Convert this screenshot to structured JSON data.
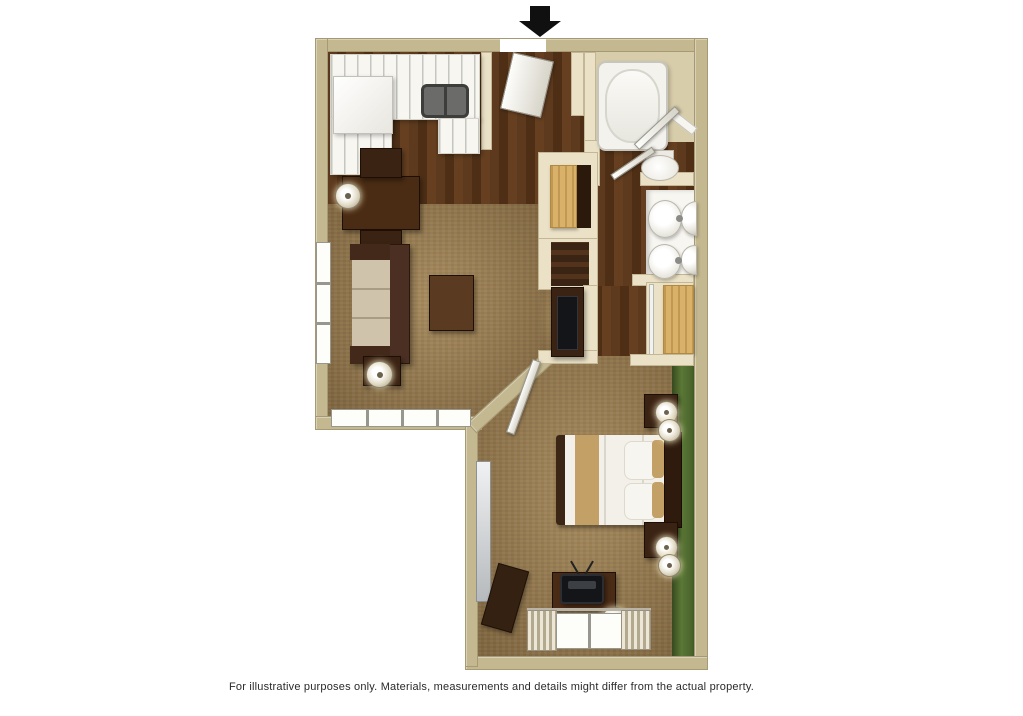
{
  "caption": "For illustrative purposes only.  Materials, measurements and details might differ from the actual property.",
  "entry_marker": "down-arrow",
  "palette": {
    "background": "#ffffff",
    "wall_tan": "#c4b891",
    "wall_edge": "#a59a74",
    "wall_cream": "#eae1c6",
    "wood_a": "#5d3a1e",
    "wood_b": "#4e2f16",
    "wood_c": "#653f20",
    "carpet": "#97794c",
    "green_a": "#5b7836",
    "fixture_white": "#f4f2ea",
    "counter_white": "#f7f6f1",
    "furn_dark": "#3b2313",
    "closet_wood": "#d9b168",
    "bed_gold": "#c3a065",
    "tv_black": "#141518",
    "arrow_color": "#101010",
    "caption_color": "#2a2a2a"
  },
  "scene": {
    "type": "3d-floor-plan-top-view",
    "rooms": [
      {
        "name": "kitchen",
        "furniture": [
          "l-shaped-counter",
          "refrigerator",
          "sink",
          "dining-table",
          "two-chairs",
          "wall-lamp"
        ]
      },
      {
        "name": "entry",
        "furniture": [
          "open-entry-door"
        ]
      },
      {
        "name": "living-room",
        "furniture": [
          "sofa",
          "end-table-with-lamp",
          "coffee-table",
          "tv-console",
          "side-window",
          "bottom-windows"
        ]
      },
      {
        "name": "bathroom",
        "furniture": [
          "bathtub",
          "toilet",
          "open-door",
          "towel-bar"
        ]
      },
      {
        "name": "vanity-area",
        "furniture": [
          "double-sinks",
          "mirror-reflections",
          "open-door"
        ]
      },
      {
        "name": "closets",
        "furniture": [
          "louvered-closet-door",
          "sliding-wood-closet-door",
          "linen-shelf"
        ]
      },
      {
        "name": "bedroom",
        "furniture": [
          "queen-bed",
          "two-nightstands",
          "four-lamps",
          "tv-desk",
          "tv",
          "curtained-window",
          "mirror-panel",
          "luggage-bench",
          "green-accent-wall",
          "open-door"
        ]
      }
    ]
  }
}
